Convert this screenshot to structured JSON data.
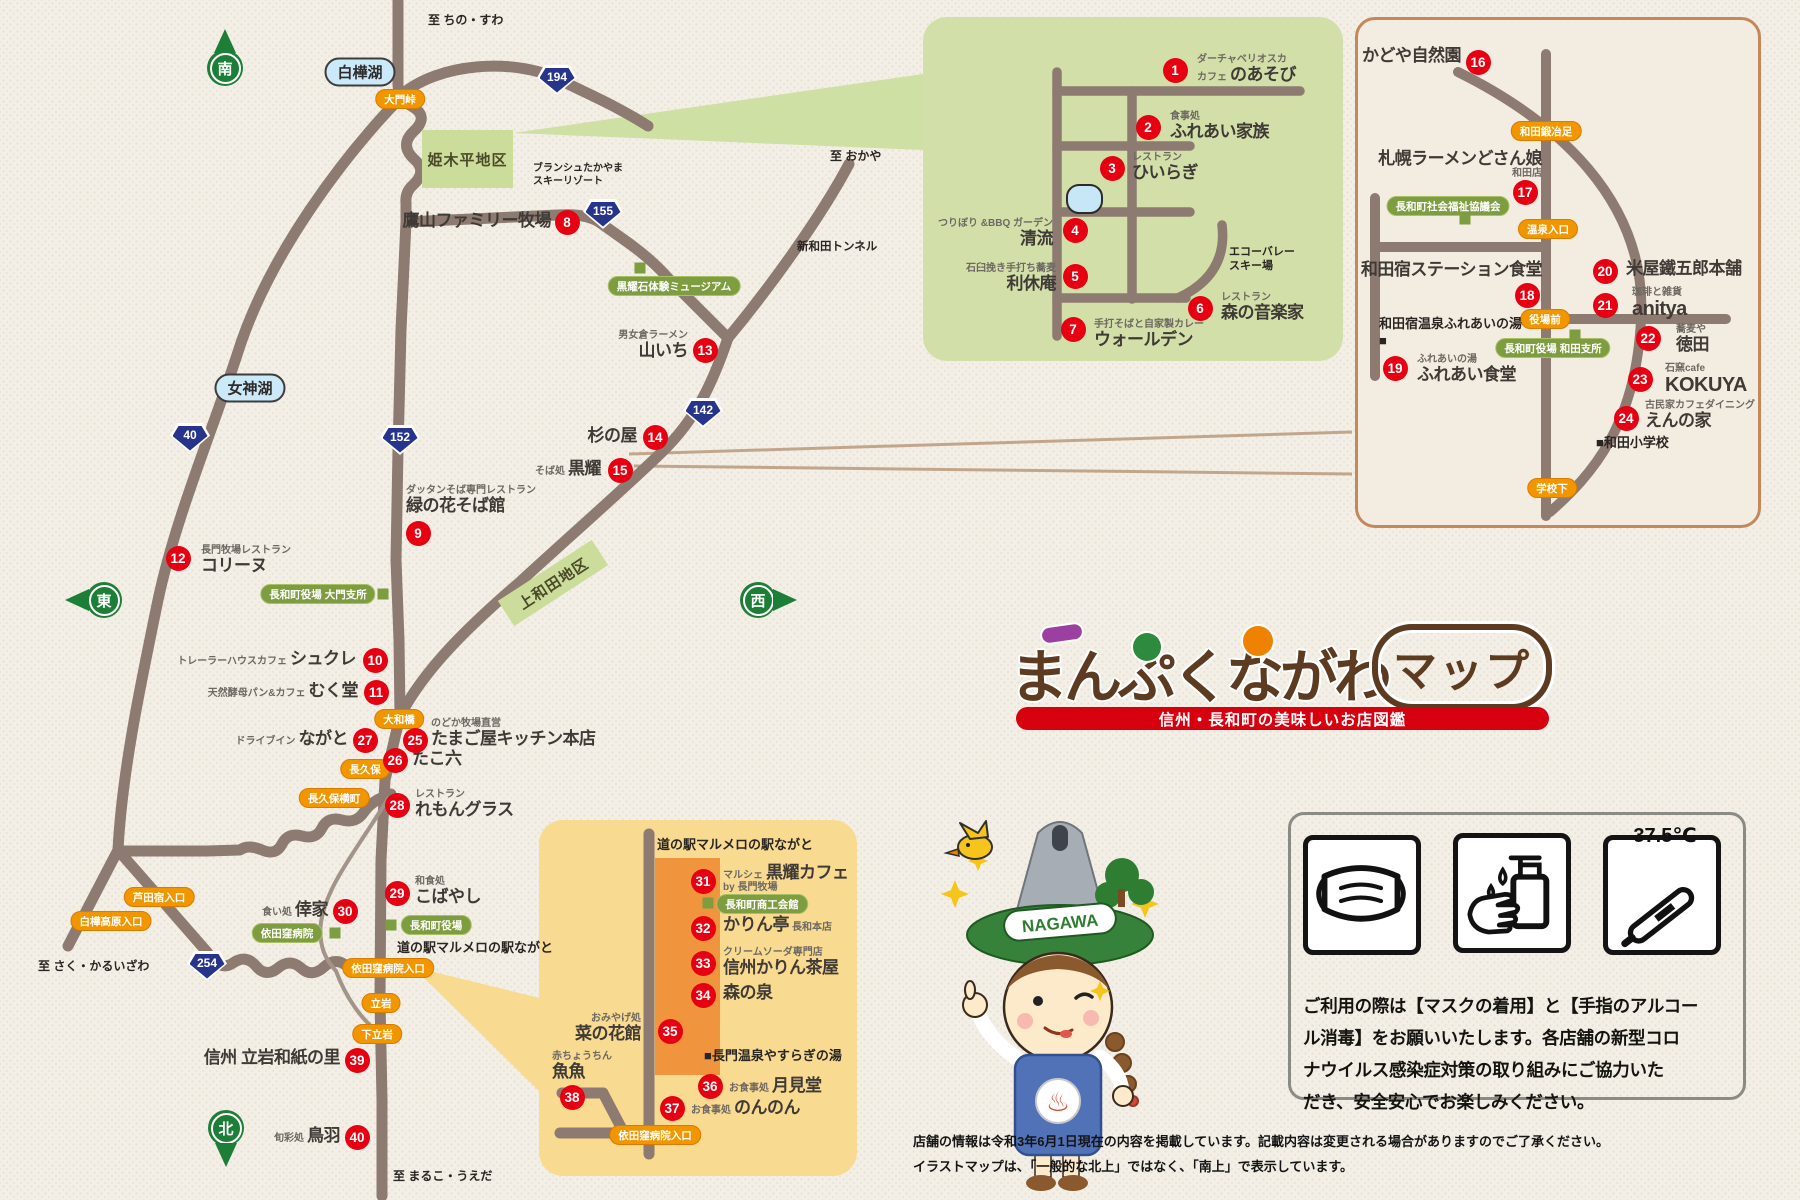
{
  "logo": {
    "title": "まんぷくながわ",
    "badge": "マップ",
    "subtitle": "信州・長和町の美味しいお店図鑑"
  },
  "notice": {
    "temperature": "37.5℃",
    "body": "ご利用の際は【マスクの着用】と【手指のアルコー\nル消毒】をお願いいたします。各店舗の新型コロ\nナウイルス感染症対策の取り組みにご協力いた\nだき、安全安心でお楽しみください。"
  },
  "footer": {
    "line1": "店舗の情報は令和3年6月1日現在の内容を掲載しています。記載内容は変更される場合がありますのでご了承ください。",
    "line2": "イラストマップは、「一般的な北上」ではなく、「南上」で表示しています。"
  },
  "mascot": {
    "hat_text": "NAGAWA",
    "badge_symbol": "♨"
  },
  "map": {
    "pois": [
      {
        "n": 1,
        "cx": 1175,
        "cy": 70,
        "tx": 1197,
        "ty": 54,
        "al": "l",
        "sub": "ダーチャベリオスカ",
        "pre": "カフェ",
        "name": "のあそび"
      },
      {
        "n": 2,
        "cx": 1148,
        "cy": 127,
        "tx": 1170,
        "ty": 111,
        "al": "l",
        "sub": "食事処",
        "name": "ふれあい家族"
      },
      {
        "n": 3,
        "cx": 1112,
        "cy": 168,
        "tx": 1132,
        "ty": 152,
        "al": "l",
        "sub": "レストラン",
        "name": "ひいらぎ"
      },
      {
        "n": 4,
        "cx": 1075,
        "cy": 230,
        "tx": 1053,
        "ty": 218,
        "al": "r",
        "sub": "つりぼり &BBQ ガーデン",
        "name": "清流"
      },
      {
        "n": 5,
        "cx": 1075,
        "cy": 276,
        "tx": 1056,
        "ty": 263,
        "al": "r",
        "sub": "石臼挽き手打ち蕎麦",
        "name": "利休庵"
      },
      {
        "n": 6,
        "cx": 1200,
        "cy": 308,
        "tx": 1221,
        "ty": 292,
        "al": "l",
        "sub": "レストラン",
        "name": "森の音楽家"
      },
      {
        "n": 7,
        "cx": 1073,
        "cy": 329,
        "tx": 1094,
        "ty": 319,
        "al": "l",
        "sub": "手打そばと自家製カレー",
        "name": "ウォールデン"
      },
      {
        "n": 8,
        "cx": 567,
        "cy": 222,
        "tx": 551,
        "ty": 211,
        "al": "r",
        "name": "鷹山ファミリー牧場"
      },
      {
        "n": 9,
        "cx": 418,
        "cy": 533,
        "tx": 406,
        "ty": 485,
        "al": "l",
        "sub": "ダッタンそば専門レストラン",
        "name": "緑の花そば館"
      },
      {
        "n": 10,
        "cx": 375,
        "cy": 660,
        "tx": 356,
        "ty": 649,
        "al": "r",
        "pre": "トレーラーハウスカフェ",
        "name": "シュクレ"
      },
      {
        "n": 11,
        "cx": 376,
        "cy": 692,
        "tx": 358,
        "ty": 681,
        "al": "r",
        "pre": "天然酵母パン&カフェ",
        "name": "むく堂"
      },
      {
        "n": 12,
        "cx": 178,
        "cy": 558,
        "tx": 201,
        "ty": 545,
        "al": "l",
        "sub": "長門牧場レストラン",
        "name": "コリーヌ"
      },
      {
        "n": 13,
        "cx": 705,
        "cy": 350,
        "tx": 688,
        "ty": 330,
        "al": "r",
        "sub": "男女倉ラーメン",
        "name": "山いち"
      },
      {
        "n": 14,
        "cx": 655,
        "cy": 437,
        "tx": 637,
        "ty": 426,
        "al": "r",
        "name": "杉の屋"
      },
      {
        "n": 15,
        "cx": 620,
        "cy": 470,
        "tx": 601,
        "ty": 459,
        "al": "r",
        "pre": "そば処",
        "name": "黒耀"
      },
      {
        "n": 16,
        "cx": 1478,
        "cy": 62,
        "tx": 1461,
        "ty": 46,
        "al": "r",
        "name": "かどや自然園"
      },
      {
        "n": 17,
        "cx": 1525,
        "cy": 192,
        "tx": 1542,
        "ty": 149,
        "al": "r",
        "name": "札幌ラーメンどさん娘",
        "after": "和田店"
      },
      {
        "n": 18,
        "cx": 1527,
        "cy": 295,
        "tx": 1542,
        "ty": 260,
        "al": "r",
        "name": "和田宿ステーション食堂"
      },
      {
        "n": 19,
        "cx": 1395,
        "cy": 368,
        "tx": 1417,
        "ty": 354,
        "al": "l",
        "sub": "ふれあいの湯",
        "name": "ふれあい食堂"
      },
      {
        "n": 20,
        "cx": 1605,
        "cy": 271,
        "tx": 1626,
        "ty": 259,
        "al": "l",
        "name": "米屋鐵五郎本舗"
      },
      {
        "n": 21,
        "cx": 1605,
        "cy": 305,
        "tx": 1632,
        "ty": 287,
        "al": "l",
        "sub": "珈琲と雑貨",
        "name": "anitya",
        "ns": 20
      },
      {
        "n": 22,
        "cx": 1648,
        "cy": 338,
        "tx": 1676,
        "ty": 324,
        "al": "l",
        "sub": "蕎麦や",
        "name": "徳田"
      },
      {
        "n": 23,
        "cx": 1640,
        "cy": 379,
        "tx": 1665,
        "ty": 363,
        "al": "l",
        "sub": "石窯cafe",
        "name": "KOKUYA",
        "ns": 20
      },
      {
        "n": 24,
        "cx": 1626,
        "cy": 418,
        "tx": 1645,
        "ty": 400,
        "al": "l",
        "sub": "古民家カフェダイニング",
        "name": "えんの家"
      },
      {
        "n": 25,
        "cx": 415,
        "cy": 740,
        "tx": 431,
        "ty": 718,
        "al": "l",
        "sub": "のどか牧場直営",
        "name": "たまご屋キッチン本店"
      },
      {
        "n": 26,
        "cx": 395,
        "cy": 760,
        "tx": 412,
        "ty": 749,
        "al": "l",
        "name": "たこ六"
      },
      {
        "n": 27,
        "cx": 365,
        "cy": 740,
        "tx": 348,
        "ty": 729,
        "al": "r",
        "pre": "ドライブイン",
        "name": "ながと"
      },
      {
        "n": 28,
        "cx": 397,
        "cy": 805,
        "tx": 415,
        "ty": 789,
        "al": "l",
        "sub": "レストラン",
        "name": "れもんグラス"
      },
      {
        "n": 29,
        "cx": 397,
        "cy": 893,
        "tx": 415,
        "ty": 876,
        "al": "l",
        "sub": "和食処",
        "name": "こばやし"
      },
      {
        "n": 30,
        "cx": 345,
        "cy": 911,
        "tx": 328,
        "ty": 900,
        "al": "r",
        "pre": "食い処",
        "name": "倖家"
      },
      {
        "n": 31,
        "cx": 703,
        "cy": 881,
        "tx": 723,
        "ty": 863,
        "al": "l",
        "pre": "マルシェ",
        "name": "黒耀カフェ",
        "after": "by 長門牧場"
      },
      {
        "n": 32,
        "cx": 703,
        "cy": 928,
        "tx": 723,
        "ty": 915,
        "al": "l",
        "name": "かりん亭",
        "post": "長和本店"
      },
      {
        "n": 33,
        "cx": 703,
        "cy": 963,
        "tx": 723,
        "ty": 947,
        "al": "l",
        "sub": "クリームソーダ専門店",
        "name": "信州かりん茶屋"
      },
      {
        "n": 34,
        "cx": 703,
        "cy": 995,
        "tx": 723,
        "ty": 983,
        "al": "l",
        "name": "森の泉"
      },
      {
        "n": 35,
        "cx": 670,
        "cy": 1031,
        "tx": 641,
        "ty": 1013,
        "al": "r",
        "sub": "おみやげ処",
        "name": "菜の花館"
      },
      {
        "n": 36,
        "cx": 710,
        "cy": 1086,
        "tx": 729,
        "ty": 1076,
        "al": "l",
        "pre": "お食事処",
        "name": "月見堂"
      },
      {
        "n": 37,
        "cx": 672,
        "cy": 1108,
        "tx": 691,
        "ty": 1098,
        "al": "l",
        "pre": "お食事処",
        "name": "のんのん"
      },
      {
        "n": 38,
        "cx": 572,
        "cy": 1097,
        "tx": 552,
        "ty": 1051,
        "al": "l",
        "sub": "赤ちょうちん",
        "name": "魚魚"
      },
      {
        "n": 39,
        "cx": 357,
        "cy": 1060,
        "tx": 340,
        "ty": 1048,
        "al": "r",
        "name": "信州 立岩和紙の里"
      },
      {
        "n": 40,
        "cx": 357,
        "cy": 1137,
        "tx": 340,
        "ty": 1126,
        "al": "r",
        "pre": "旬彩処",
        "name": "鳥羽"
      }
    ],
    "pills": [
      {
        "t": "大門峠",
        "x": 400,
        "y": 99,
        "k": "orange"
      },
      {
        "t": "大和橋",
        "x": 399,
        "y": 719,
        "k": "orange"
      },
      {
        "t": "長久保",
        "x": 365,
        "y": 769,
        "k": "orange"
      },
      {
        "t": "長久保横町",
        "x": 334,
        "y": 798,
        "k": "orange"
      },
      {
        "t": "芦田宿入口",
        "x": 159,
        "y": 897,
        "k": "orange"
      },
      {
        "t": "白樺高原入口",
        "x": 111,
        "y": 921,
        "k": "orange"
      },
      {
        "t": "依田窪病院入口",
        "x": 388,
        "y": 968,
        "k": "orange"
      },
      {
        "t": "立岩",
        "x": 381,
        "y": 1003,
        "k": "orange"
      },
      {
        "t": "下立岩",
        "x": 377,
        "y": 1034,
        "k": "orange"
      },
      {
        "t": "依田窪病院入口",
        "x": 655,
        "y": 1135,
        "k": "orange"
      },
      {
        "t": "和田鍛冶足",
        "x": 1546,
        "y": 131,
        "k": "orange"
      },
      {
        "t": "温泉入口",
        "x": 1548,
        "y": 229,
        "k": "orange"
      },
      {
        "t": "役場前",
        "x": 1545,
        "y": 319,
        "k": "orange"
      },
      {
        "t": "学校下",
        "x": 1552,
        "y": 488,
        "k": "orange"
      },
      {
        "t": "黒耀石体験ミュージアム",
        "x": 674,
        "y": 286,
        "k": "green"
      },
      {
        "t": "長和町役場 大門支所",
        "x": 318,
        "y": 594,
        "k": "green"
      },
      {
        "t": "依田窪病院",
        "x": 287,
        "y": 933,
        "k": "green"
      },
      {
        "t": "長和町役場",
        "x": 436,
        "y": 925,
        "k": "green"
      },
      {
        "t": "長和町社会福祉協議会",
        "x": 1448,
        "y": 206,
        "k": "green"
      },
      {
        "t": "長和町役場 和田支所",
        "x": 1553,
        "y": 348,
        "k": "green"
      },
      {
        "t": "長和町商工会館",
        "x": 762,
        "y": 904,
        "k": "green"
      },
      {
        "t": "白樺湖",
        "x": 360,
        "y": 72,
        "k": "lake"
      },
      {
        "t": "女神湖",
        "x": 250,
        "y": 388,
        "k": "lake"
      }
    ],
    "squares": [
      {
        "x": 640,
        "y": 268
      },
      {
        "x": 383,
        "y": 594
      },
      {
        "x": 335,
        "y": 933
      },
      {
        "x": 391,
        "y": 925
      },
      {
        "x": 1465,
        "y": 219
      },
      {
        "x": 1575,
        "y": 335
      },
      {
        "x": 708,
        "y": 903
      }
    ],
    "badges": [
      {
        "t": "194",
        "x": 557,
        "y": 80
      },
      {
        "t": "155",
        "x": 603,
        "y": 214
      },
      {
        "t": "40",
        "x": 190,
        "y": 438
      },
      {
        "t": "152",
        "x": 400,
        "y": 440
      },
      {
        "t": "142",
        "x": 703,
        "y": 413
      },
      {
        "t": "254",
        "x": 207,
        "y": 966
      }
    ],
    "areas": [
      {
        "t": "姫木平地区",
        "x": 422,
        "y": 130,
        "w": 91,
        "h": 58,
        "rot": 0
      },
      {
        "t": "上和田地区",
        "x": 497,
        "y": 568,
        "w": 112,
        "h": 30,
        "rot": -33
      }
    ],
    "labels": [
      {
        "t": "至 ちの・すわ",
        "x": 428,
        "y": 13,
        "s": 12
      },
      {
        "t": "至 おかや",
        "x": 830,
        "y": 149,
        "s": 12
      },
      {
        "t": "至 さく・かるいざわ",
        "x": 38,
        "y": 959,
        "s": 12
      },
      {
        "t": "至 まるこ・うえだ",
        "x": 393,
        "y": 1169,
        "s": 12
      },
      {
        "t": "ブランシュたかやま\nスキーリゾート",
        "x": 533,
        "y": 162,
        "s": 10
      },
      {
        "t": "新和田トンネル",
        "x": 797,
        "y": 240,
        "s": 11.5
      },
      {
        "t": "エコーバレー\nスキー場",
        "x": 1229,
        "y": 245,
        "s": 11
      },
      {
        "t": "道の駅マルメロの駅ながと",
        "x": 397,
        "y": 940,
        "s": 13
      },
      {
        "t": "道の駅マルメロの駅ながと",
        "x": 657,
        "y": 837,
        "s": 13
      },
      {
        "t": "■長門温泉やすらぎの湯",
        "x": 704,
        "y": 1048,
        "s": 13
      },
      {
        "t": "和田宿温泉ふれあいの湯\n■",
        "x": 1379,
        "y": 316,
        "s": 13
      },
      {
        "t": "■和田小学校",
        "x": 1596,
        "y": 435,
        "s": 13
      }
    ],
    "compass": [
      {
        "t": "南",
        "x": 225,
        "y": 68,
        "dir": "up",
        "name": "south"
      },
      {
        "t": "東",
        "x": 104,
        "y": 600,
        "dir": "left",
        "name": "east"
      },
      {
        "t": "西",
        "x": 758,
        "y": 600,
        "dir": "right",
        "name": "west"
      },
      {
        "t": "北",
        "x": 226,
        "y": 1128,
        "dir": "down",
        "name": "north"
      }
    ]
  }
}
